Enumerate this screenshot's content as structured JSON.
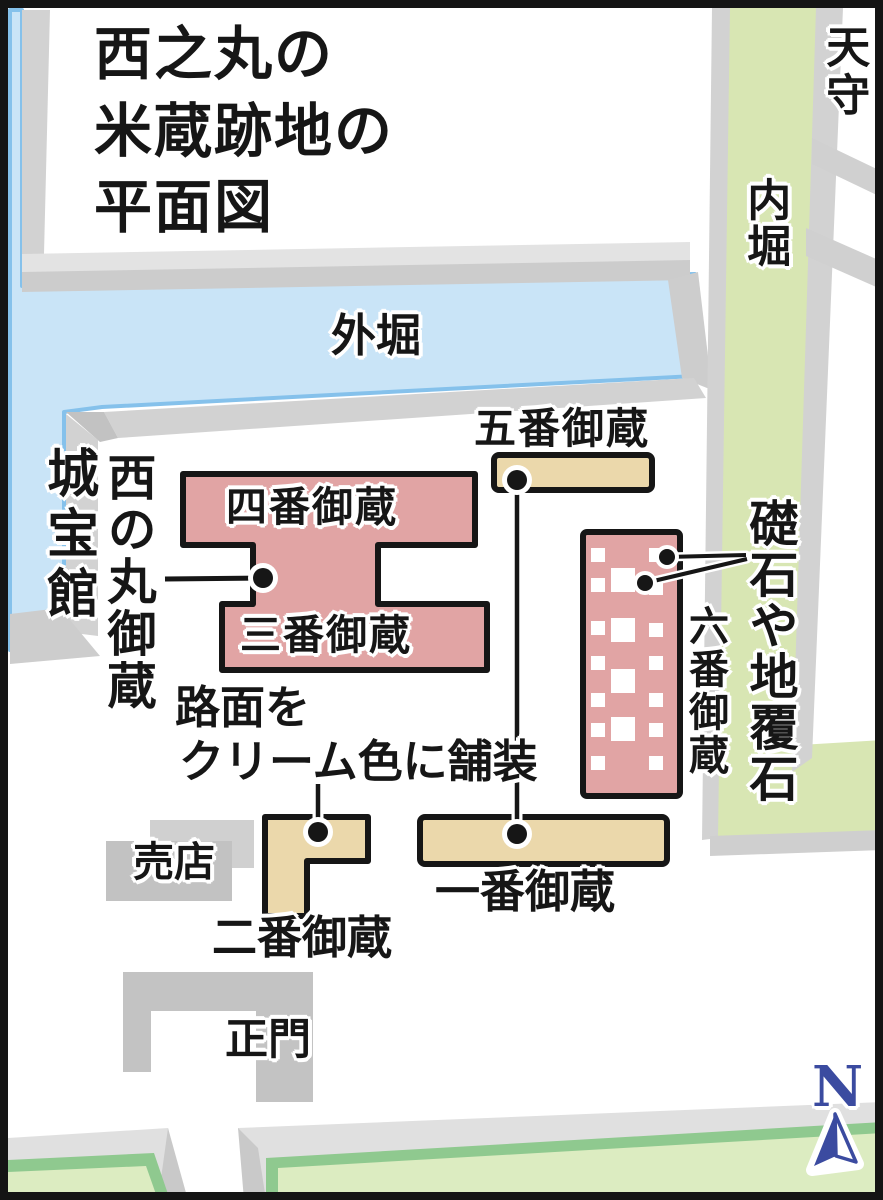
{
  "title": {
    "line1": "西之丸の",
    "line2": "米蔵跡地の",
    "line3": "平面図"
  },
  "labels": {
    "tenshu": "天守",
    "uchibori": "内堀",
    "sotobori": "外堀",
    "johokan": "城宝館",
    "nishinomaru_okura": "西の丸御蔵",
    "kura4": "四番御蔵",
    "kura3": "三番御蔵",
    "kura5": "五番御蔵",
    "kura6": "六番御蔵",
    "kura2": "二番御蔵",
    "kura1": "一番御蔵",
    "baiten": "売店",
    "seimon": "正門"
  },
  "annotations": {
    "foundation_stones": "礎石や地覆石",
    "pavement_line1": "路面を",
    "pavement_line2": "クリーム色に舗装"
  },
  "compass": {
    "label": "N"
  },
  "colors": {
    "moat_water": "#c9e4f7",
    "moat_water_edge": "#85c1eb",
    "inner_moat_green": "#d8e6b3",
    "bank_green_light": "#dcecc1",
    "bank_green_dark": "#8fc98f",
    "wall_gray_light": "#e0e0e0",
    "wall_gray": "#d2d2d2",
    "wall_gray_dark": "#c6c6c6",
    "building_pink": "#e1a4a4",
    "pavement_cream": "#ebd8ab",
    "line_black": "#161616",
    "compass_blue": "#3b4ba0"
  }
}
